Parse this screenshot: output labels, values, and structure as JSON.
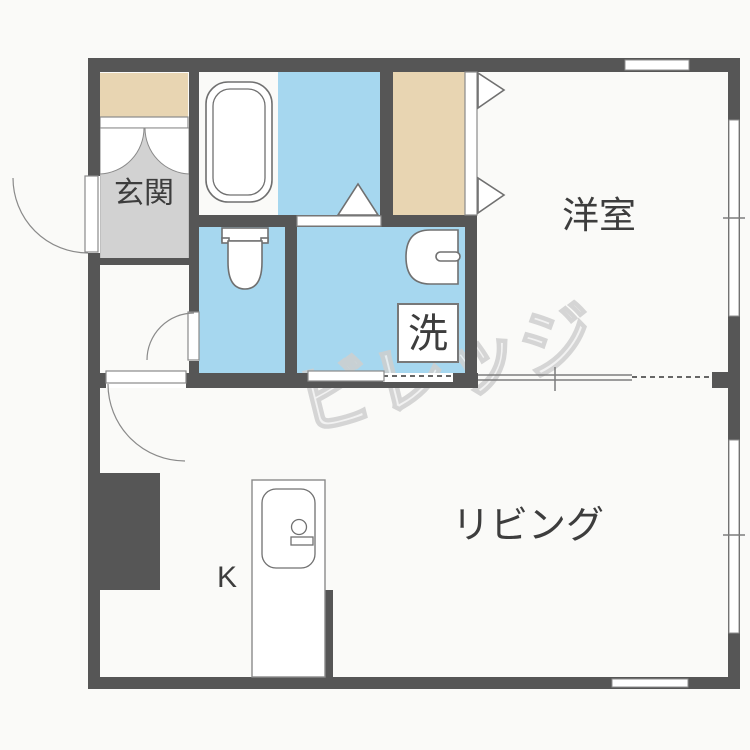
{
  "floorplan": {
    "watermark": "ビレッジ",
    "labels": {
      "entrance": "玄関",
      "western_room": "洋室",
      "living": "リビング",
      "kitchen": "K",
      "laundry": "洗"
    },
    "rooms": [
      {
        "id": "entrance",
        "label": "玄関",
        "floor": "gray"
      },
      {
        "id": "bathroom",
        "label": "",
        "floor": "blue",
        "fixtures": [
          "bathtub"
        ]
      },
      {
        "id": "toilet-room",
        "label": "",
        "floor": "blue",
        "fixtures": [
          "toilet"
        ]
      },
      {
        "id": "washroom",
        "label": "洗",
        "floor": "blue",
        "fixtures": [
          "wash-basin",
          "washing-machine-space"
        ]
      },
      {
        "id": "closet",
        "label": "",
        "floor": "tan",
        "fixtures": [
          "folding-doors"
        ]
      },
      {
        "id": "western-room",
        "label": "洋室",
        "floor": "white"
      },
      {
        "id": "living",
        "label": "リビング",
        "floor": "white",
        "fixtures": [
          "kitchen-counter",
          "kitchen-sink"
        ]
      }
    ],
    "colors": {
      "wall": "#565656",
      "wet_area": "#a6d7ef",
      "closet": "#e8d5b2",
      "entrance_floor": "#d2d2d2",
      "fixture_stroke": "#707070",
      "label_text": "#3d3d3d",
      "watermark": "#cfcfcf"
    }
  }
}
